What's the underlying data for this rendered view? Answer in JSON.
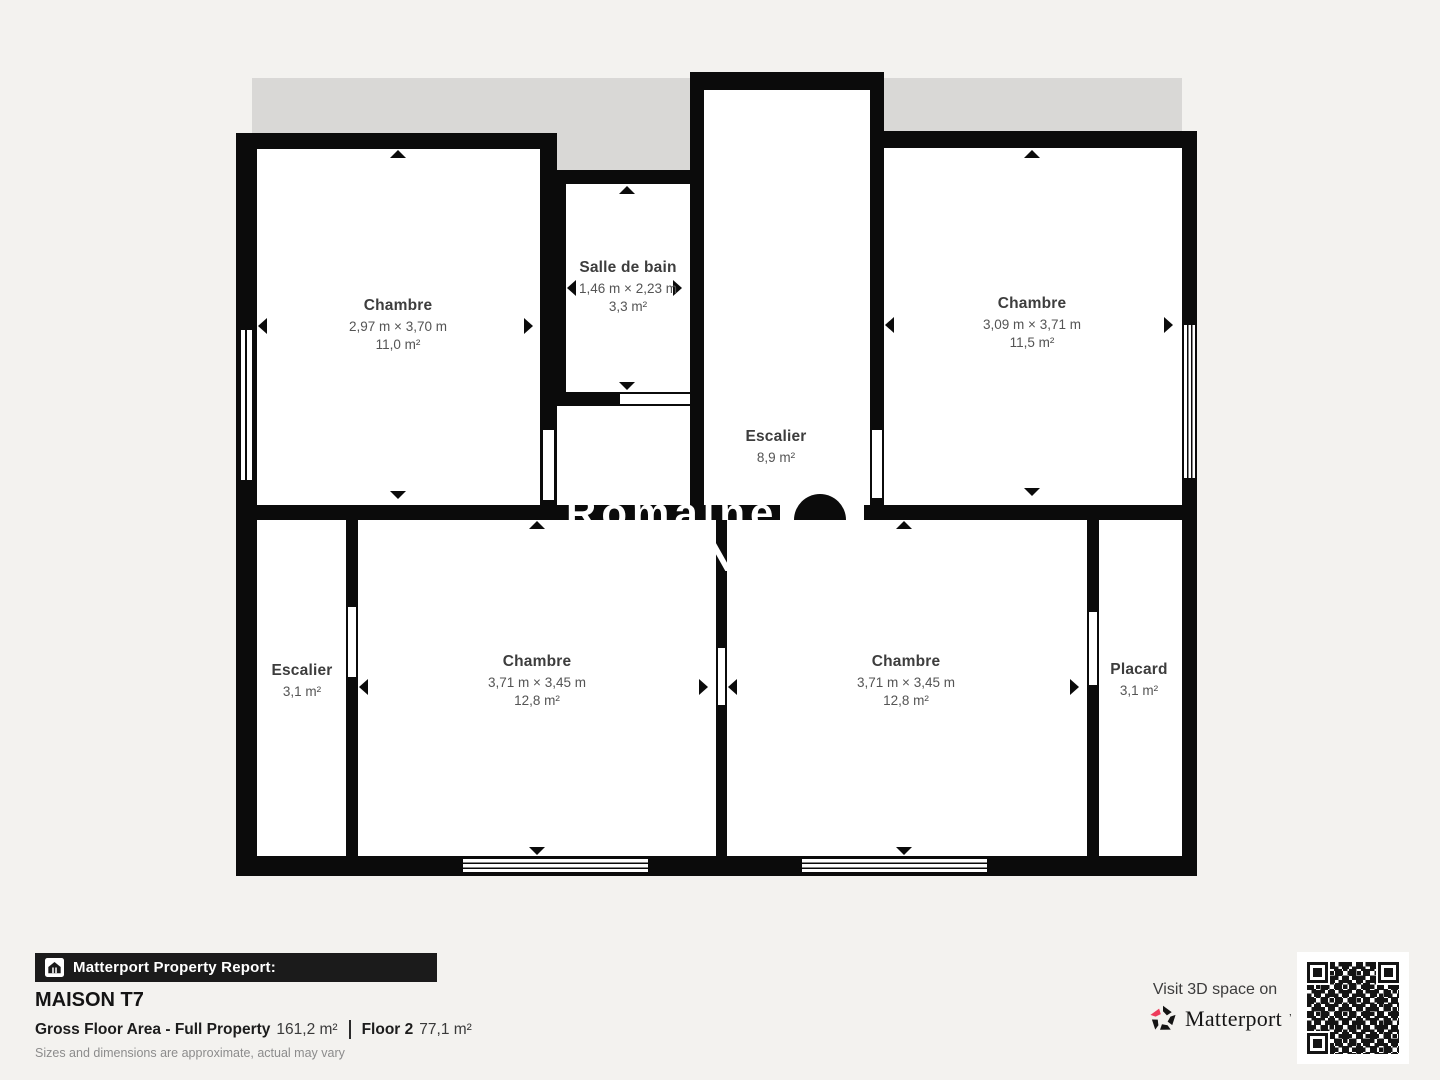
{
  "colors": {
    "wall": "#0b0b0b",
    "gray_band": "#d9d8d6",
    "page_bg": "#f3f2ef",
    "brand_pink": "#ee3c5c",
    "footer_bar": "#1b1b1b"
  },
  "plan": {
    "rooms": {
      "chambre_tl": {
        "name": "Chambre",
        "dims": "2,97 m × 3,70 m",
        "area": "11,0 m²"
      },
      "salle_de_bain": {
        "name": "Salle de bain",
        "dims": "1,46 m × 2,23 m",
        "area": "3,3 m²"
      },
      "escalier_haut": {
        "name": "Escalier",
        "area": "8,9 m²"
      },
      "chambre_tr": {
        "name": "Chambre",
        "dims": "3,09 m × 3,71 m",
        "area": "11,5 m²"
      },
      "escalier_bas": {
        "name": "Escalier",
        "area": "3,1 m²"
      },
      "chambre_bl": {
        "name": "Chambre",
        "dims": "3,71 m × 3,45 m",
        "area": "12,8 m²"
      },
      "chambre_br": {
        "name": "Chambre",
        "dims": "3,71 m × 3,45 m",
        "area": "12,8 m²"
      },
      "placard": {
        "name": "Placard",
        "area": "3,1 m²"
      }
    },
    "watermark": {
      "text": "Romaines",
      "initial": "N"
    }
  },
  "footer": {
    "report_label": "Matterport Property Report:",
    "property_title": "MAISON T7",
    "gfa_label": "Gross Floor Area - Full Property",
    "gfa_value": "161,2 m²",
    "floor_label": "Floor 2",
    "floor_value": "77,1 m²",
    "disclaimer": "Sizes and dimensions are approximate, actual may vary",
    "visit_label": "Visit 3D space on",
    "brand": "Matterport",
    "brand_tm": "ʼ"
  }
}
